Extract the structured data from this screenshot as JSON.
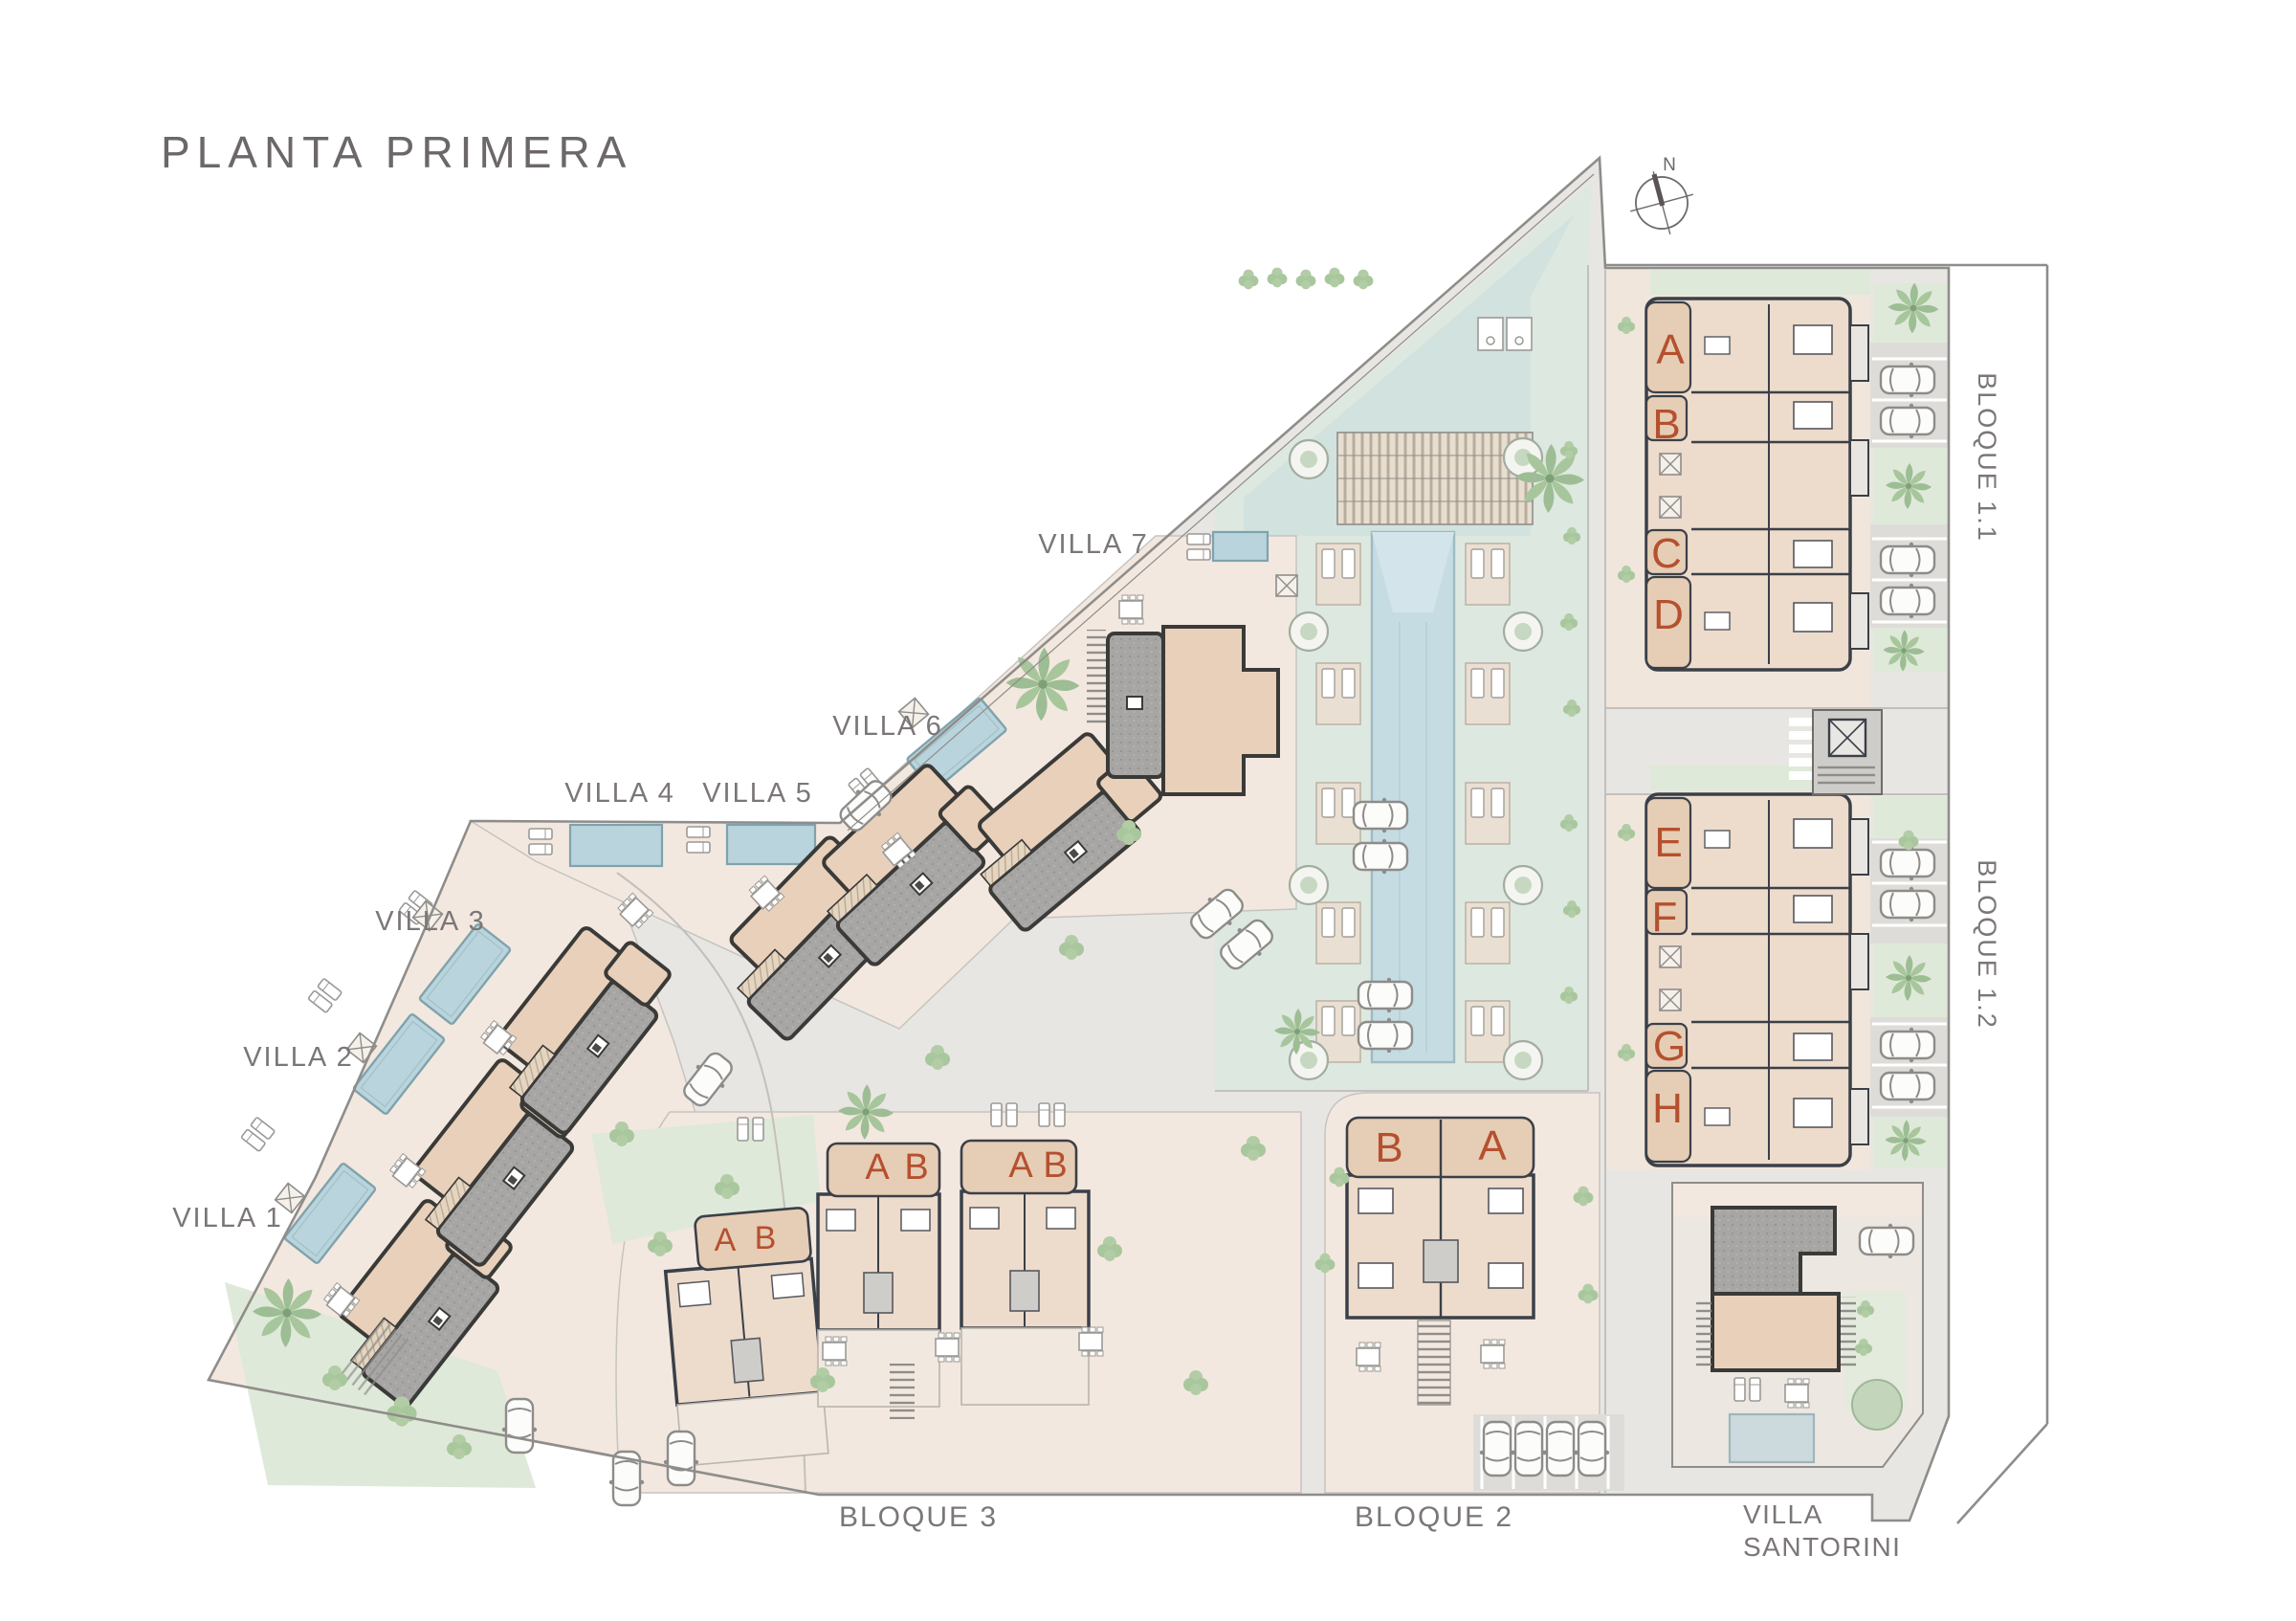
{
  "title": "PLANTA PRIMERA",
  "compass": {
    "label": "N"
  },
  "villas": [
    {
      "label": "VILLA 1"
    },
    {
      "label": "VILLA 2"
    },
    {
      "label": "VILLA 3"
    },
    {
      "label": "VILLA 4"
    },
    {
      "label": "VILLA 5"
    },
    {
      "label": "VILLA 6"
    },
    {
      "label": "VILLA 7"
    }
  ],
  "blocks": {
    "b11": {
      "label": "BLOQUE 1.1",
      "units": [
        "A",
        "B",
        "C",
        "D"
      ]
    },
    "b12": {
      "label": "BLOQUE 1.2",
      "units": [
        "E",
        "F",
        "G",
        "H"
      ]
    },
    "b2": {
      "label": "BLOQUE 2",
      "units": [
        "B",
        "A"
      ]
    },
    "b3": {
      "label": "BLOQUE 3",
      "buildings": [
        {
          "units": [
            "A",
            "B"
          ]
        },
        {
          "units": [
            "A",
            "B"
          ]
        },
        {
          "units": [
            "A",
            "B"
          ]
        }
      ]
    },
    "santorini": {
      "line1": "VILLA",
      "line2": "SANTORINI"
    }
  },
  "colors": {
    "unit_letter": "#b5502f",
    "label_text": "#7b7677",
    "title_text": "#6c6768",
    "pool_blue": "#b9d4dc",
    "lap_pool": "#c6dce3",
    "roof_gray": "#a7a6a4",
    "building_tan": "#e8d0ba",
    "interior": "#eddbcc",
    "terrace_tan": "#e6cdb5",
    "plot_pink": "#f3e8df",
    "community_green": "#dde8e0",
    "community_teal": "#d2e2de",
    "garden_green": "#dfe9d9",
    "paving": "#e8e6e2",
    "wall_dark": "#3b4048"
  }
}
